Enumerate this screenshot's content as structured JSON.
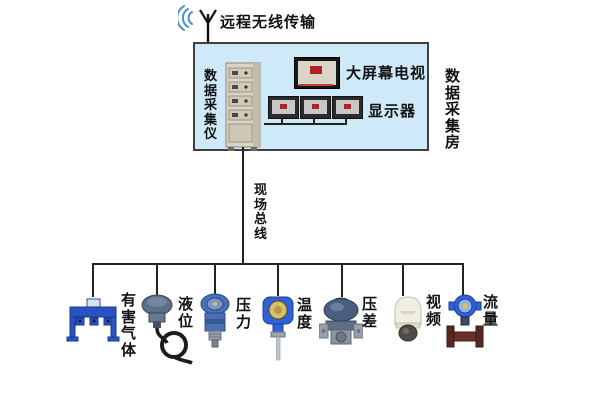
{
  "title": "数据采集系统结构图",
  "colors": {
    "line": "#222222",
    "room_fill": "#cfe9f8",
    "signal_blue": "#4a90c4",
    "logo_red": "#b22222",
    "device_blue": "#2f62d6",
    "cabinet_beige": "#d9d4c3",
    "flange_maroon": "#6b3029"
  },
  "wireless": {
    "label": "远程无线传输"
  },
  "room": {
    "label": "数据采集房",
    "daq_label": "数据采集仪",
    "tv_label": "大屏幕电视",
    "monitors_label": "显示器",
    "monitor_count": 3
  },
  "bus": {
    "label": "现场总线"
  },
  "devices": [
    {
      "name": "harmful-gas",
      "label": "有害气体"
    },
    {
      "name": "liquid-level",
      "label": "液位"
    },
    {
      "name": "pressure",
      "label": "压力"
    },
    {
      "name": "temperature",
      "label": "温度"
    },
    {
      "name": "differential-pressure",
      "label": "压差"
    },
    {
      "name": "video",
      "label": "视频"
    },
    {
      "name": "flow",
      "label": "流量"
    }
  ]
}
